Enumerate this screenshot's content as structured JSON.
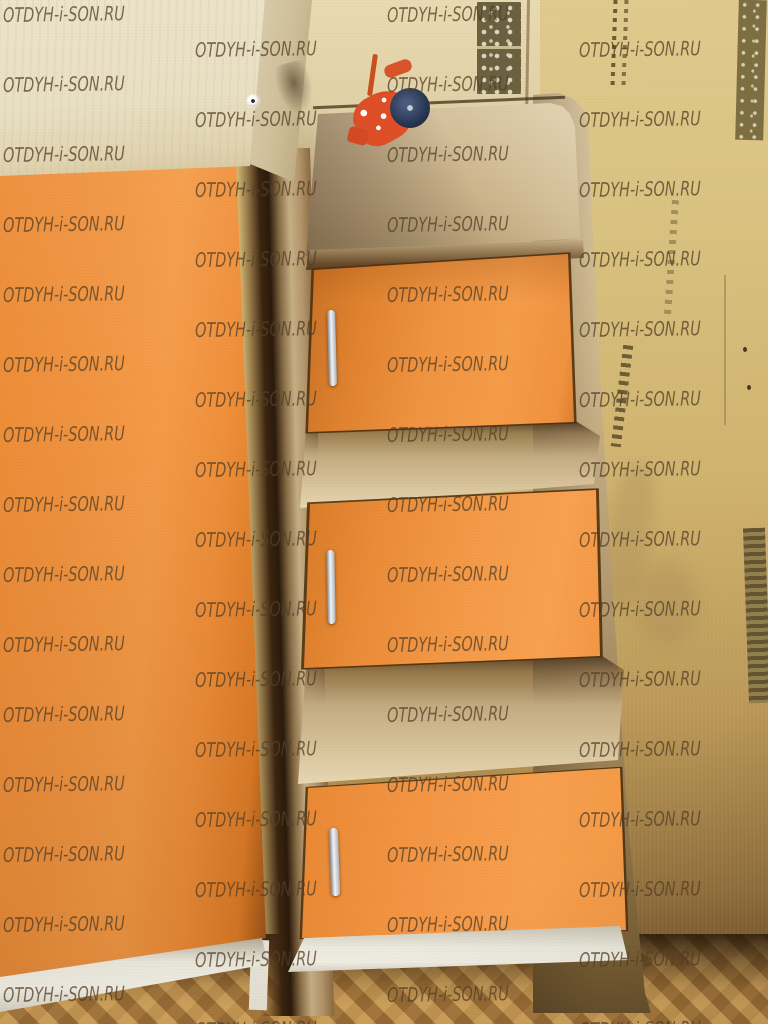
{
  "watermark": {
    "text": "OTDYH-i-SON.RU",
    "color": "rgba(82,62,38,0.8)",
    "grid": {
      "columns_x": [
        3,
        195,
        387,
        579,
        771
      ],
      "row_start_even": 3,
      "row_start_odd": 38,
      "row_spacing": 70,
      "image_height": 1024
    }
  },
  "palette": {
    "orange_front": "#f09340",
    "orange_bright": "#f8a14f",
    "orange_shadow": "#d57c2a",
    "cabinet_cream": "#ebe3ca",
    "unit_beige": "#d2bd95",
    "wall_back": "#e4d5ad",
    "wall_right": "#d5bb77",
    "wall_pattern_dark": "#6b6040",
    "plinth_white": "#ebe8dd",
    "handle_metal": "#dfe3e6",
    "floor_light": "#cfa057",
    "floor_dark": "#7e5a2d",
    "toy_red": "#de4f28",
    "toy_wheel_navy": "#263450"
  },
  "scene": {
    "objects": [
      {
        "name": "upper-cabinet"
      },
      {
        "name": "wardrobe-door"
      },
      {
        "name": "stair-chest",
        "drawer_count": 3,
        "handle_count": 3
      },
      {
        "name": "toy-motorcycle"
      },
      {
        "name": "patterned-wallpaper"
      },
      {
        "name": "herringbone-parquet-floor"
      }
    ]
  }
}
